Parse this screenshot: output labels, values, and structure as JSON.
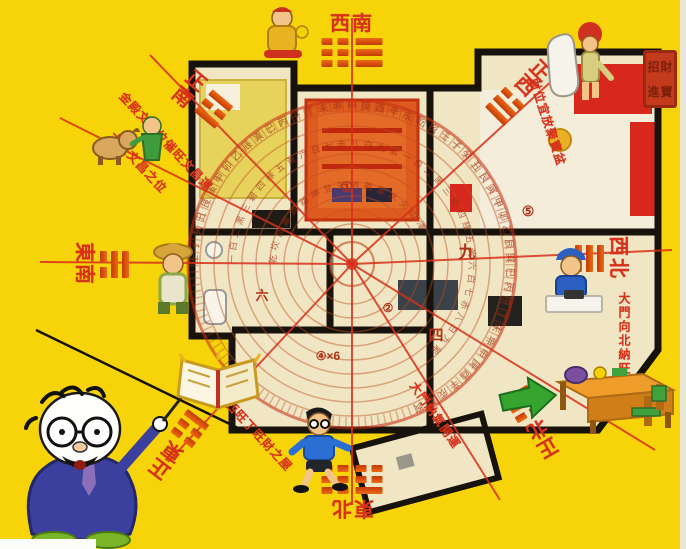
{
  "background": {
    "color": "#F7D40A",
    "edge_right_color": "#EAE5D8",
    "corner_strip_color": "#FBFBF9"
  },
  "palette": {
    "wall": "#17120C",
    "floor": "#F1E6C3",
    "floor_light": "#F4EDD9",
    "red_accent": "#D8281E",
    "ring_stroke": "#C05020",
    "ring_text": "#9E2E14",
    "ray_red": "#D8301B",
    "trigram_bar": "#DF4A10",
    "numeral": "#B03018"
  },
  "directions": [
    {
      "id": "south",
      "label": "正南",
      "x": 203,
      "y": 100,
      "rot": 40,
      "stack": true,
      "layout": "row",
      "order": "label-first",
      "trigrams": [
        [
          "solid",
          "broken",
          "solid"
        ]
      ]
    },
    {
      "id": "southwest",
      "label": "西南",
      "x": 352,
      "y": 40,
      "rot": 0,
      "stack": false,
      "layout": "column",
      "order": "label-first",
      "trigrams": [
        [
          "broken",
          "broken",
          "broken"
        ],
        [
          "solid",
          "solid",
          "solid"
        ]
      ]
    },
    {
      "id": "west",
      "label": "正西",
      "x": 521,
      "y": 90,
      "rot": 45,
      "stack": true,
      "layout": "column",
      "order": "label-first",
      "trigrams": [
        [
          "broken",
          "solid",
          "solid"
        ]
      ]
    },
    {
      "id": "northwest",
      "label": "西北",
      "x": 602,
      "y": 258,
      "rot": 90,
      "stack": false,
      "layout": "column",
      "order": "label-first",
      "trigrams": [
        [
          "solid",
          "solid",
          "solid"
        ]
      ]
    },
    {
      "id": "north",
      "label": "正北",
      "x": 534,
      "y": 424,
      "rot": 150,
      "stack": true,
      "layout": "column",
      "order": "label-first",
      "trigrams": [
        [
          "broken",
          "solid",
          "broken"
        ]
      ]
    },
    {
      "id": "northeast",
      "label": "東北",
      "x": 352,
      "y": 492,
      "rot": 180,
      "stack": false,
      "layout": "column",
      "order": "label-first",
      "trigrams": [
        [
          "solid",
          "broken",
          "broken"
        ],
        [
          "broken",
          "broken",
          "broken"
        ]
      ]
    },
    {
      "id": "southeast",
      "label": "東南",
      "x": 102,
      "y": 264,
      "rot": 90,
      "stack": false,
      "layout": "column",
      "order": "trigram-first",
      "trigrams": [
        [
          "solid",
          "solid",
          "broken"
        ]
      ]
    },
    {
      "id": "east",
      "label": "正東",
      "x": 176,
      "y": 447,
      "rot": 217,
      "stack": true,
      "layout": "column",
      "order": "label-first",
      "trigrams": [
        [
          "broken",
          "broken",
          "solid"
        ]
      ]
    }
  ],
  "compass": {
    "center_x": 352,
    "center_y": 264,
    "outer_radius": 164,
    "ring_radii": [
      152,
      138,
      124,
      110,
      96,
      82,
      68,
      54,
      40
    ],
    "ring_texts": [
      {
        "radius": 155,
        "size": 10,
        "chars": "壬子癸丑艮寅甲卯乙辰巽巳丙午丁未坤申庚酉辛戌乾亥壬子癸丑艮寅甲卯乙辰巽巳丙午丁未坤申庚酉辛戌乾亥"
      },
      {
        "radius": 117,
        "size": 9,
        "chars": "一白二黑三碧四綠五黃六白七赤八白九紫一白二黑三碧四綠五黃六白七赤八白九紫"
      },
      {
        "radius": 76,
        "size": 9,
        "chars": "乾坎艮震巽離坤兌天地風雷水火山澤"
      }
    ],
    "rays": [
      [
        150,
        55
      ],
      [
        352,
        18
      ],
      [
        568,
        66
      ],
      [
        672,
        250
      ],
      [
        655,
        450
      ],
      [
        352,
        505
      ],
      [
        168,
        462
      ],
      [
        40,
        262
      ],
      [
        500,
        500
      ],
      [
        60,
        118
      ]
    ],
    "numerals": [
      {
        "t": "①",
        "x": 347,
        "y": 192,
        "s": 14
      },
      {
        "t": "⑤",
        "x": 528,
        "y": 216,
        "s": 14
      },
      {
        "t": "九",
        "x": 467,
        "y": 258,
        "s": 17
      },
      {
        "t": "四",
        "x": 436,
        "y": 340,
        "s": 15
      },
      {
        "t": "④×6",
        "x": 328,
        "y": 360,
        "s": 12
      },
      {
        "t": "六",
        "x": 262,
        "y": 300,
        "s": 13
      },
      {
        "t": "②",
        "x": 388,
        "y": 312,
        "s": 12
      }
    ]
  },
  "annotations": [
    {
      "text": "金殿文昌位催旺文昌運",
      "x": 128,
      "y": 88,
      "rot": 47,
      "vert": false
    },
    {
      "text": "大旺文昌之位",
      "x": 118,
      "y": 128,
      "rot": 47,
      "vert": false
    },
    {
      "text": "坐東向西旺丁旺財之屋",
      "x": 208,
      "y": 368,
      "rot": 47,
      "vert": false
    },
    {
      "text": "財位宜放聚寶盆",
      "x": 542,
      "y": 76,
      "rot": 72,
      "vert": false
    },
    {
      "text": "大門向北納旺氣",
      "x": 616,
      "y": 292,
      "rot": 0,
      "vert": true
    },
    {
      "text": "大門納氣開運",
      "x": 420,
      "y": 378,
      "rot": 55,
      "vert": false
    }
  ],
  "seal": {
    "chars": [
      "招",
      "財",
      "進",
      "寶"
    ]
  },
  "cartoons": [
    "professor-character",
    "gold-boy-character",
    "dog-and-green-figure-character",
    "sock-boy-character",
    "worker-character",
    "farmer-character",
    "golden-book",
    "running-boy-character",
    "study-desk",
    "green-arrow-icon",
    "red-seal"
  ]
}
